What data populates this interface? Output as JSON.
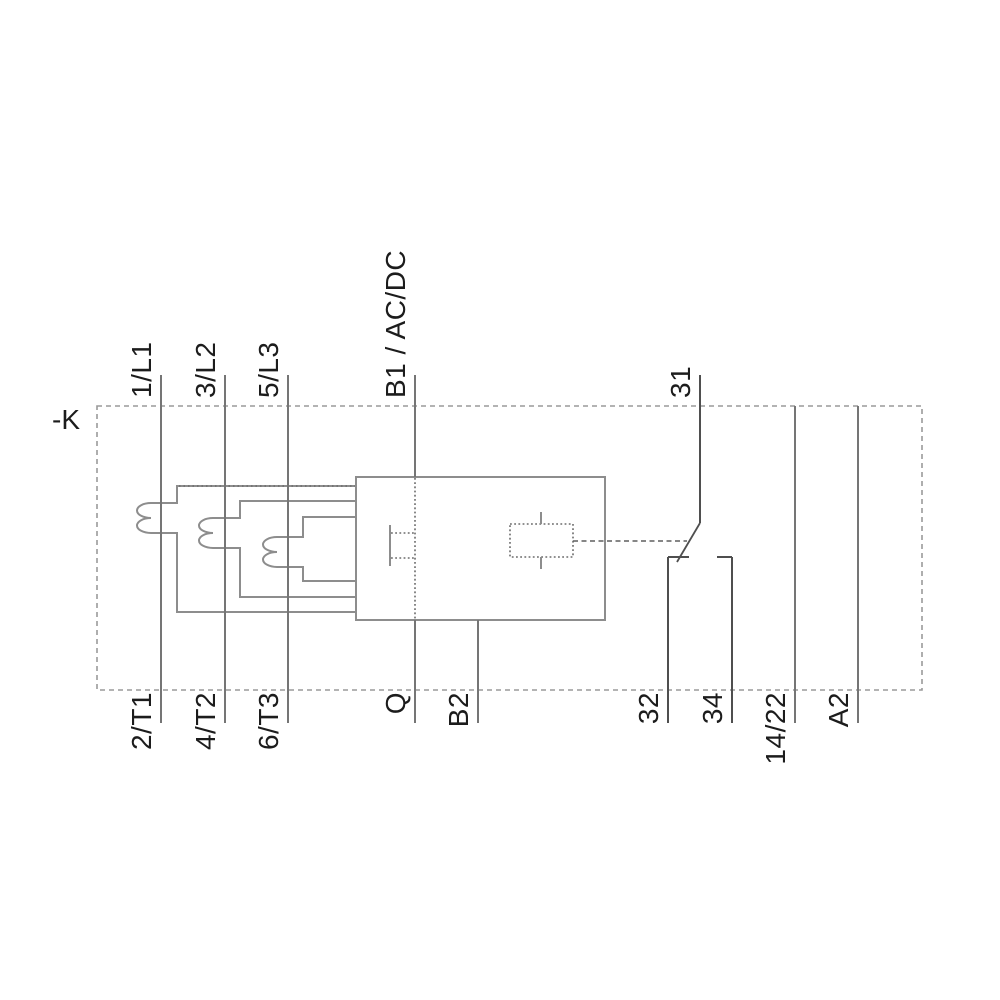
{
  "device": {
    "designation": "-K",
    "type": "overload-relay-circuit-diagram"
  },
  "terminals": {
    "top": [
      {
        "id": "1L1",
        "label": "1/L1"
      },
      {
        "id": "3L2",
        "label": "3/L2"
      },
      {
        "id": "5L3",
        "label": "5/L3"
      },
      {
        "id": "B1",
        "label": "B1 / AC/DC"
      },
      {
        "id": "31",
        "label": "31"
      }
    ],
    "bottom": [
      {
        "id": "2T1",
        "label": "2/T1"
      },
      {
        "id": "4T2",
        "label": "4/T2"
      },
      {
        "id": "6T3",
        "label": "6/T3"
      },
      {
        "id": "Q",
        "label": "Q"
      },
      {
        "id": "B2",
        "label": "B2"
      },
      {
        "id": "32",
        "label": "32"
      },
      {
        "id": "34",
        "label": "34"
      },
      {
        "id": "1422",
        "label": "14/22"
      },
      {
        "id": "A2",
        "label": "A2"
      }
    ]
  },
  "colors": {
    "label": "#1c1c1c",
    "line": "#757575",
    "outline": "#8d8d8d",
    "border": "#9a9a9a",
    "detail": "#6b6b6b",
    "dark": "#4f4f4f"
  }
}
